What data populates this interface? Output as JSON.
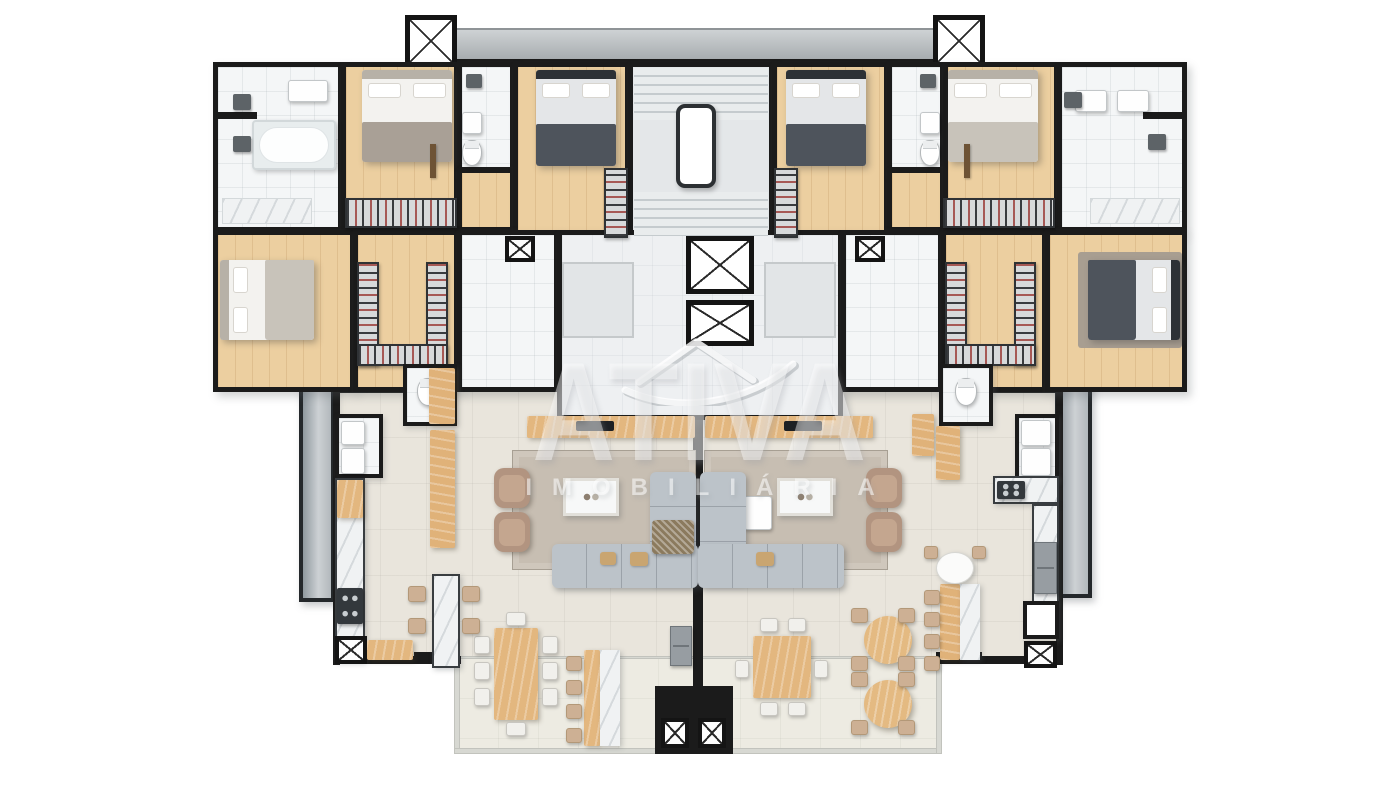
{
  "watermark": {
    "brand": "ATIVA",
    "subtitle": "IMOBILIÁRIA",
    "logo_mark": "chevron-over-arc"
  },
  "palette": {
    "wall": "#1b1b1b",
    "wood_floor": "#eccfa0",
    "wood_furniture": "#e3b77f",
    "bathroom_tile": "#f4f6f7",
    "living_floor": "#e9e5dc",
    "terrace_floor": "#edebe2",
    "marble": "#f0f2f3",
    "sofa": "#bcc3c9",
    "armchair": "#b29480",
    "rug": "#c7beb2",
    "glass_rail": "#9aa2a8",
    "concrete_band": "#b6babd",
    "clothes_accent": "#96312d",
    "dark_bedding": "#4e545c"
  },
  "floor_plan": {
    "view": "top-down-3d-render",
    "building_core": {
      "elevators": [
        "elevator-1",
        "elevator-2"
      ],
      "stairwell": "central-stairwell",
      "hall": "elevator-hall",
      "shafts": [
        "shaft-top-left",
        "shaft-top-right",
        "shaft-hall-left",
        "shaft-hall-right",
        "shaft-kitchen-left",
        "shaft-kitchen-right",
        "shaft-bottom-1",
        "shaft-bottom-2"
      ]
    },
    "units": [
      {
        "name": "apartment-left",
        "rooms": [
          "bathroom-suite",
          "bedroom-suite",
          "bathroom-2",
          "bedroom-2",
          "bedroom-master",
          "walk-in-closet",
          "corridor",
          "wc",
          "laundry",
          "kitchen",
          "living-room",
          "dining-area",
          "terrace",
          "service-balcony"
        ],
        "furniture": [
          "double-bed-x3",
          "wardrobe-racks",
          "bathtub",
          "l-shaped-sofa",
          "armchair-x2",
          "coffee-table",
          "tv-console",
          "rug",
          "dining-table-8-seats",
          "bar-counter-4-stools",
          "island-4-chairs",
          "cooktop",
          "fridge",
          "washer",
          "sink"
        ]
      },
      {
        "name": "apartment-right",
        "rooms": [
          "bathroom-suite",
          "bedroom-suite",
          "bathroom-2",
          "bedroom-2",
          "bedroom-master",
          "walk-in-closet",
          "corridor",
          "wc",
          "laundry",
          "kitchen",
          "living-room",
          "dining-area",
          "terrace",
          "service-balcony"
        ],
        "furniture": [
          "double-bed-x3",
          "wardrobe-racks",
          "double-sink",
          "l-shaped-sofa",
          "armchair-x2",
          "coffee-table",
          "tv-console",
          "rug",
          "dining-table-6-seats",
          "round-table-x2",
          "island-4-stools",
          "round-white-table",
          "cooktop",
          "oven",
          "washer",
          "sink"
        ]
      }
    ]
  }
}
